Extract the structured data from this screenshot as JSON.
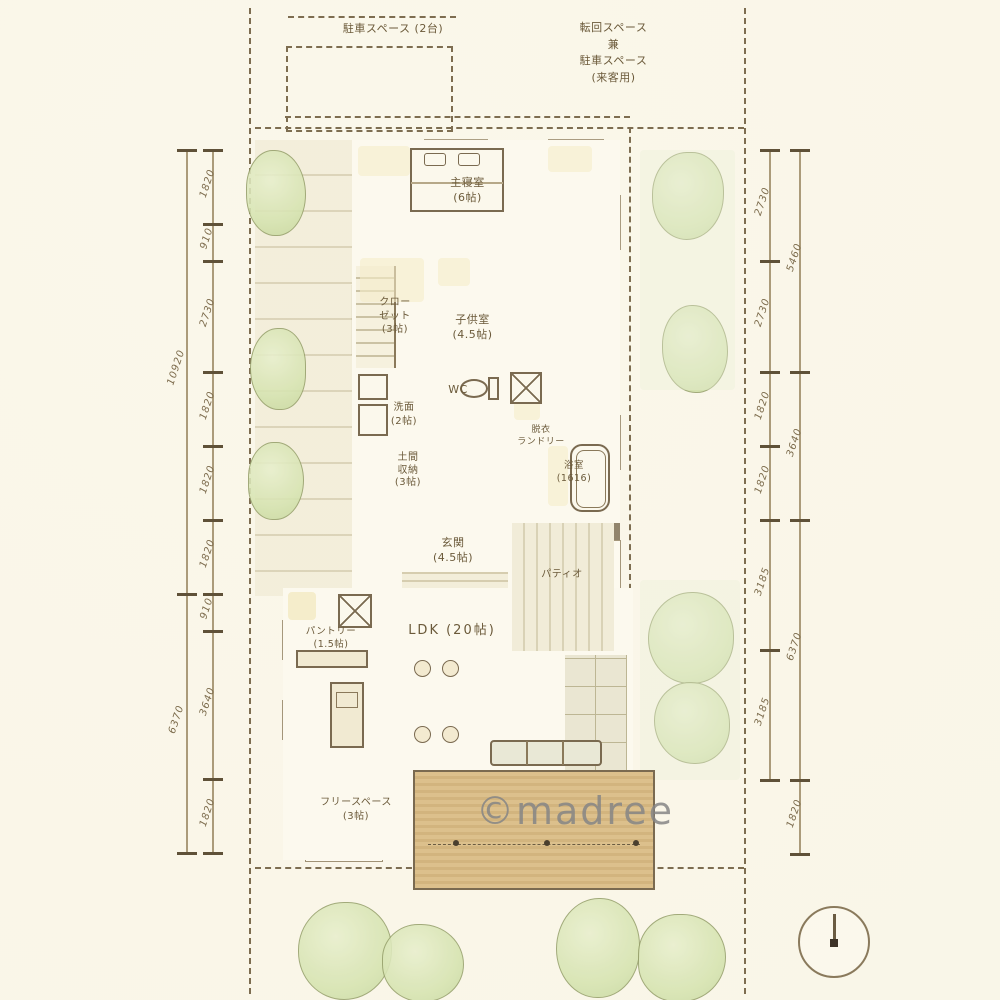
{
  "site": {
    "parking_label": "駐車スペース (2台)",
    "turnaround_label": "転回スペース\n兼\n駐車スペース\n(来客用)"
  },
  "rooms": {
    "master_bedroom": "主寝室\n(6帖)",
    "closet": "クロー\nゼット\n(3帖)",
    "kids_room": "子供室\n(4.5帖)",
    "wc": "WC",
    "washroom": "洗面\n(2帖)",
    "laundry": "脱衣\nランドリー",
    "bathroom": "浴室\n(1616)",
    "doma_storage": "土間\n収納\n(3帖)",
    "entrance": "玄関\n(4.5帖)",
    "patio": "パティオ",
    "pantry": "パントリー\n(1.5帖)",
    "ldk": "LDK (20帖)",
    "free_space": "フリースペース\n(3帖)"
  },
  "dimensions": {
    "left_segments": [
      "1820",
      "910",
      "2730",
      "1820",
      "1820",
      "1820",
      "910",
      "3640",
      "1820"
    ],
    "left_totals": [
      "10920",
      "6370"
    ],
    "right_segments": [
      "2730",
      "2730",
      "1820",
      "1820",
      "3185",
      "3185"
    ],
    "right_totals": [
      "5460",
      "3640",
      "6370",
      "1820"
    ]
  },
  "watermark": "©madree",
  "colors": {
    "paper": "#fbf8ec",
    "ink": "#6f5f45",
    "wood": "#e6c98f",
    "wash_yellow": "#f5ecca",
    "wash_green": "#d5e3af"
  }
}
